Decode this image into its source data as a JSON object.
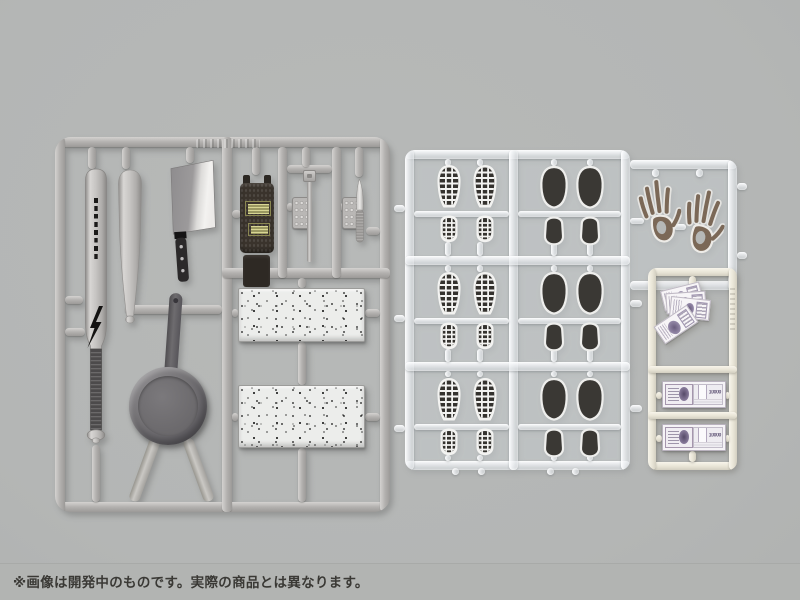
{
  "page": {
    "type": "product-photo",
    "subject": "plastic model kit runners (sprues) with crime-scene / household parts"
  },
  "colors": {
    "bg": "#b7b9b8",
    "caption_bg": "#b2b4b2",
    "caption_text": "#3a3935",
    "silver_sprue": "#b3b1af",
    "clear_sprue": "#e9edf0",
    "cream_sprue": "#efecdf",
    "print_black": "#35332f",
    "handprint_brown": "#7b6857",
    "banknote_purple": "#6d5e7e",
    "pan_gray": "#6b696c",
    "stungun_label_yellow": "#d8d694"
  },
  "caption": {
    "disclaimer": "※画像は開発中のものです。実際の商品とは異なります。"
  },
  "sprues": {
    "silver": {
      "color_name": "silver-gray",
      "parts": [
        "metal-baseball-bat-with-logo-and-lightning-bolt",
        "plain-baseball-bat",
        "chinese-cleaver",
        "stun-gun-with-yellow-labels",
        "studded-plate-small-x2",
        "square-headed-rod",
        "slim-kitchen-knife",
        "speckled-stone-slab-x2",
        "frying-pan-with-handle"
      ]
    },
    "clear": {
      "color_name": "clear-translucent",
      "parts": [
        "sneaker-footprint-pair-x3",
        "dress-shoe-sole-print-pair-x3",
        "handprint-pair"
      ]
    },
    "cream": {
      "color_name": "cream-white",
      "parts": [
        "fanned-banknotes",
        "banknote-bundle",
        "banknote-bundle"
      ]
    }
  },
  "money": {
    "denomination": "10000"
  }
}
